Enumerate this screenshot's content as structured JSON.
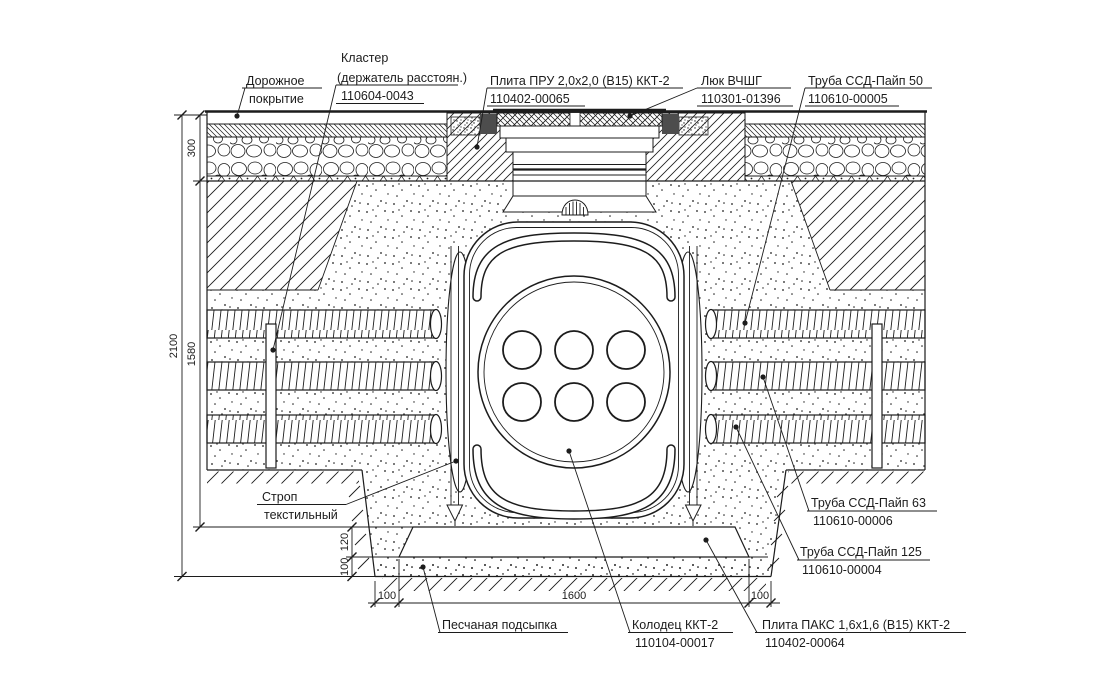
{
  "drawing": {
    "type": "construction-section",
    "title_implicit": "Установка колодца ККТ-2 (поперечный разрез)"
  },
  "labels": {
    "road_surface": {
      "line1": "Дорожное",
      "line2": "покрытие"
    },
    "cluster": {
      "line1": "Кластер",
      "line2": "(держатель расстоян.)",
      "code": "110604-0043"
    },
    "plate_pru": {
      "name": "Плита ПРУ 2,0x2,0 (В15) ККТ-2",
      "code": "110402-00065"
    },
    "lyuk": {
      "name": "Люк ВЧШГ",
      "code": "110301-01396"
    },
    "pipe_50": {
      "name": "Труба ССД-Пайп 50",
      "code": "110610-00005"
    },
    "pipe_63": {
      "name": "Труба ССД-Пайп 63",
      "code": "110610-00006"
    },
    "pipe_125": {
      "name": "Труба ССД-Пайп 125",
      "code": "110610-00004"
    },
    "strop": {
      "line1": "Строп",
      "line2": "текстильный"
    },
    "sand_bedding": {
      "name": "Песчаная подсыпка"
    },
    "well": {
      "name": "Колодец ККТ-2",
      "code": "110104-00017"
    },
    "plate_paks": {
      "name": "Плита ПАКС 1,6x1,6 (В15) ККТ-2",
      "code": "110402-00064"
    }
  },
  "dimensions": {
    "total_depth": "2100",
    "backfill_depth": "1580",
    "road_structure": "300",
    "slab_thickness": "120",
    "bedding_thickness": "100",
    "margin_left": "100",
    "slab_width": "1600",
    "margin_right": "100"
  },
  "colors": {
    "line": "#1c1c1c",
    "background": "#ffffff"
  }
}
